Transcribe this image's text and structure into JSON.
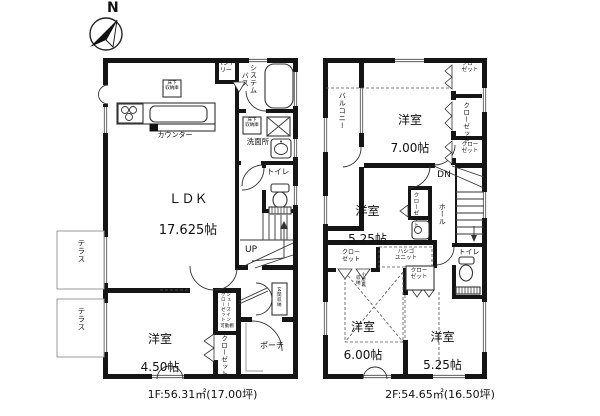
{
  "compass": {
    "north_label": "N"
  },
  "floor1": {
    "caption": "1F:56.31㎡(17.00坪)",
    "ldk_name": "ＬＤＫ",
    "ldk_size": "17.625帖",
    "bedroom_name": "洋室",
    "bedroom_size": "4.50帖",
    "pantry": "パント\nリー",
    "bath": "システム\nバス",
    "counter": "カウンター",
    "underfloor_storage1": "床下\n収納庫",
    "underfloor_storage2": "床下\n収納庫",
    "washroom": "洗面所",
    "toilet": "トイレ",
    "stairs_up": "UP",
    "closet": "クローゼット",
    "shoes_in_closet": "シューズイン\nクローゼット",
    "movable_shelf": "可動棚",
    "entrance_storage": "玄関収納",
    "porch": "ポーチ",
    "terrace1": "テラス",
    "terrace2": "テラス"
  },
  "floor2": {
    "caption": "2F:54.65㎡(16.50坪)",
    "balcony": "バルコニー",
    "bedroom7_name": "洋室",
    "bedroom7_size": "7.00帖",
    "bedroom525a_name": "洋室",
    "bedroom525a_size": "5.25帖",
    "bedroom6_name": "洋室",
    "bedroom6_size": "6.00帖",
    "bedroom525b_name": "洋室",
    "bedroom525b_size": "5.25帖",
    "hall": "ホール",
    "stairs_down": "DN",
    "toilet": "トイレ",
    "closet_top_right": "クロー\nゼット",
    "closet_right_mid": "クローゼット",
    "closet_right_low": "クロー\nゼット",
    "closet_mid": "クローゼット",
    "closet_left": "クロー\nゼット",
    "closet_bottom": "クロー\nゼット",
    "ladder_unit": "ハシゴ\nユニット",
    "attic_storage": "小屋裏\n収納"
  }
}
